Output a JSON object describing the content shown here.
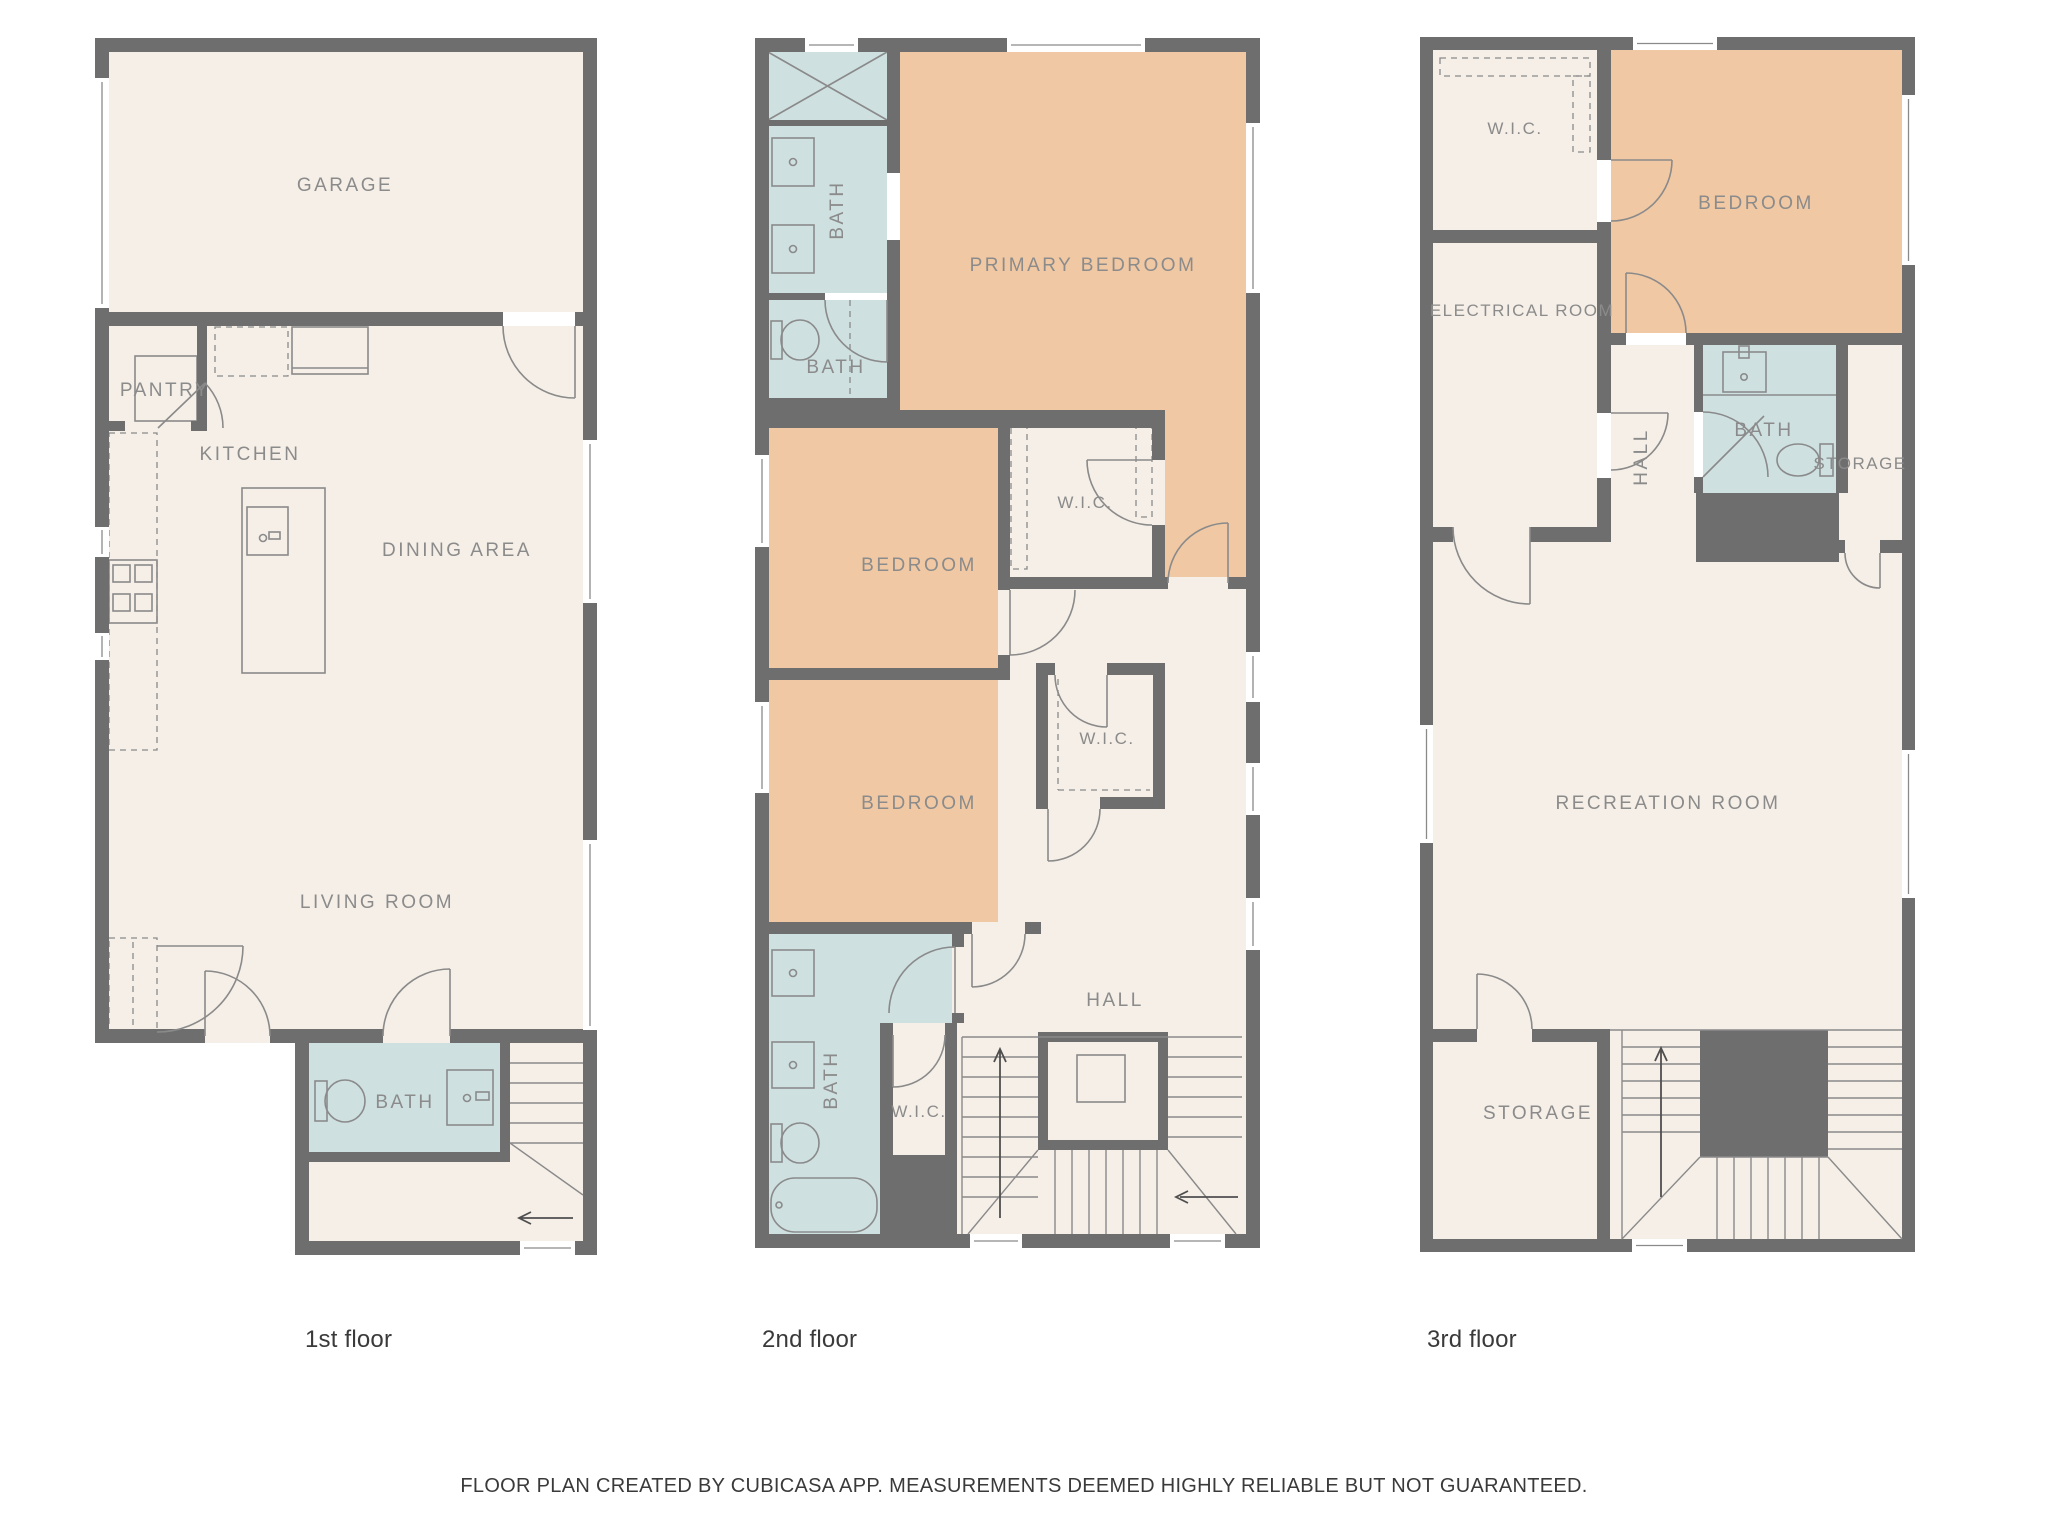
{
  "colors": {
    "wall_color": "#6e6e6e",
    "floor_color": "#f6efe7",
    "bedroom_color": "#f0c8a4",
    "bath_color": "#cfe0e0",
    "fixture_color": "#8a8a8a",
    "room_label_color": "#8b8b8b",
    "arrow_color": "#4f4f4f",
    "text_color": "#3a3a3a"
  },
  "floors": [
    {
      "name": "1st floor",
      "rooms": [
        {
          "name": "garage",
          "label": "GARAGE"
        },
        {
          "name": "pantry",
          "label": "PANTRY"
        },
        {
          "name": "kitchen",
          "label": "KITCHEN"
        },
        {
          "name": "dining-area",
          "label": "DINING AREA"
        },
        {
          "name": "living-room",
          "label": "LIVING ROOM"
        },
        {
          "name": "bath",
          "label": "BATH"
        }
      ]
    },
    {
      "name": "2nd floor",
      "rooms": [
        {
          "name": "bath-upper",
          "label": "BATH"
        },
        {
          "name": "bath-mid",
          "label": "BATH"
        },
        {
          "name": "primary-bedroom",
          "label": "PRIMARY BEDROOM"
        },
        {
          "name": "bedroom-mid",
          "label": "BEDROOM"
        },
        {
          "name": "wic-primary",
          "label": "W.I.C."
        },
        {
          "name": "bedroom-lower",
          "label": "BEDROOM"
        },
        {
          "name": "wic-mid",
          "label": "W.I.C."
        },
        {
          "name": "bath-lower",
          "label": "BATH"
        },
        {
          "name": "wic-lower",
          "label": "W.I.C."
        },
        {
          "name": "hall",
          "label": "HALL"
        }
      ]
    },
    {
      "name": "3rd floor",
      "rooms": [
        {
          "name": "wic",
          "label": "W.I.C."
        },
        {
          "name": "bedroom",
          "label": "BEDROOM"
        },
        {
          "name": "electrical-room",
          "label": "ELECTRICAL ROOM"
        },
        {
          "name": "hall",
          "label": "HALL"
        },
        {
          "name": "bath",
          "label": "BATH"
        },
        {
          "name": "storage-upper",
          "label": "STORAGE"
        },
        {
          "name": "recreation-room",
          "label": "RECREATION ROOM"
        },
        {
          "name": "storage-lower",
          "label": "STORAGE"
        }
      ]
    }
  ],
  "footer": "FLOOR PLAN CREATED BY CUBICASA APP. MEASUREMENTS DEEMED HIGHLY RELIABLE BUT NOT GUARANTEED."
}
